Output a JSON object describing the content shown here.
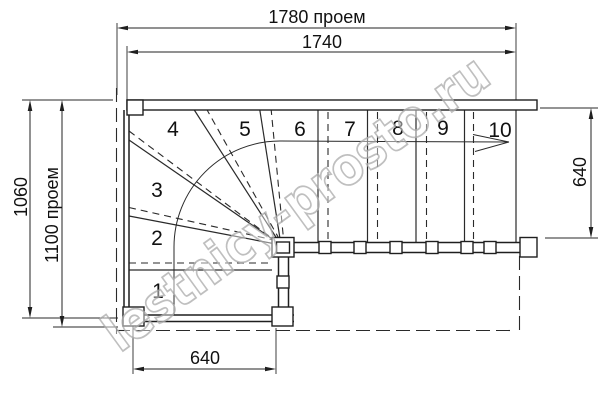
{
  "drawing": {
    "type": "staircase-floor-plan",
    "watermark": {
      "text": "lestnicy-prosto.ru"
    },
    "colors": {
      "line": "#1f1f1f",
      "watermark_outline": "#b0b0b0",
      "background": "#ffffff"
    },
    "dimensions": {
      "top_outer": "1780 проем",
      "top_inner": "1740",
      "left_outer": "1060",
      "left_inner": "1100 проем",
      "right_side": "640",
      "bottom": "640"
    },
    "steps": [
      "1",
      "2",
      "3",
      "4",
      "5",
      "6",
      "7",
      "8",
      "9",
      "10"
    ]
  }
}
